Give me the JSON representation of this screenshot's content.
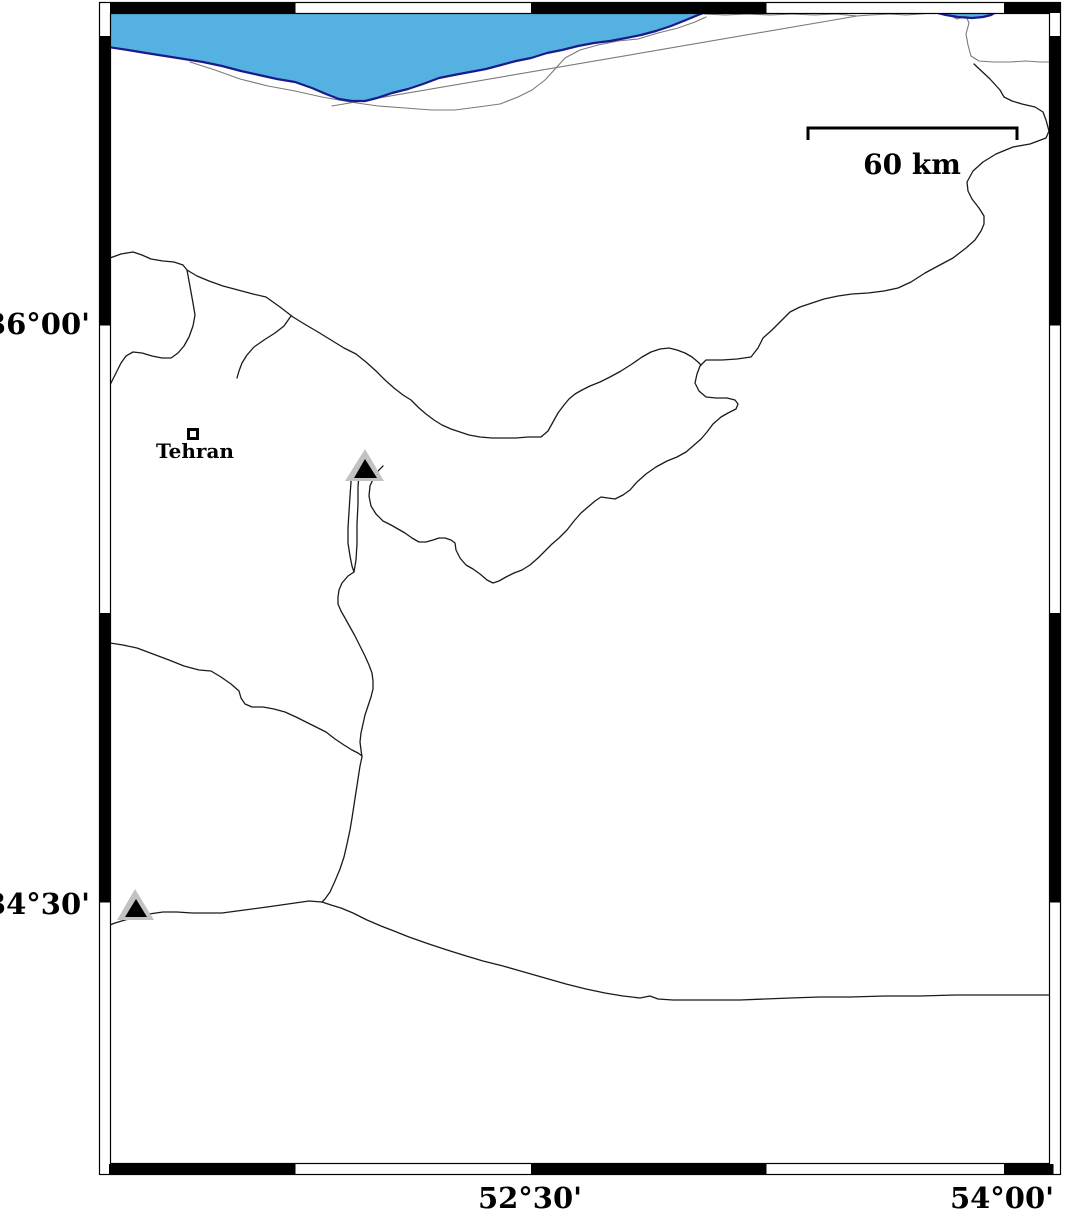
{
  "figure": {
    "type": "geographic-map",
    "style": "GMT fancy frame map",
    "region_shown": "Tehran / southern Caspian Sea area"
  },
  "frame": {
    "lat_labels": [
      {
        "text": "36°00'",
        "side": "left"
      },
      {
        "text": "34°30'",
        "side": "left"
      }
    ],
    "lon_labels": [
      {
        "text": "52°30'",
        "side": "bottom"
      },
      {
        "text": "54°00'",
        "side": "bottom"
      }
    ]
  },
  "scale_bar": {
    "label": "60 km",
    "length_px": 209
  },
  "city": {
    "name": "Tehran",
    "marker": "open-square",
    "x": 193,
    "y": 434
  },
  "markers": [
    {
      "name": "triangle-marker-1",
      "shape": "triangle",
      "x": 365,
      "y": 467
    },
    {
      "name": "triangle-marker-2",
      "shape": "triangle",
      "x": 136,
      "y": 906
    }
  ],
  "water_body": {
    "name_visible": false,
    "description": "blue sea area along top edge"
  },
  "colors": {
    "sea_fill": "#56b1e3",
    "sea_border": "#1a1a8a",
    "border_lines": "#1a1a1a",
    "detail_lines": "#7a7a7a",
    "frame": "#000000",
    "triangle_gray": "#c2c2c2",
    "triangle_black": "#000000",
    "background": "#ffffff"
  }
}
